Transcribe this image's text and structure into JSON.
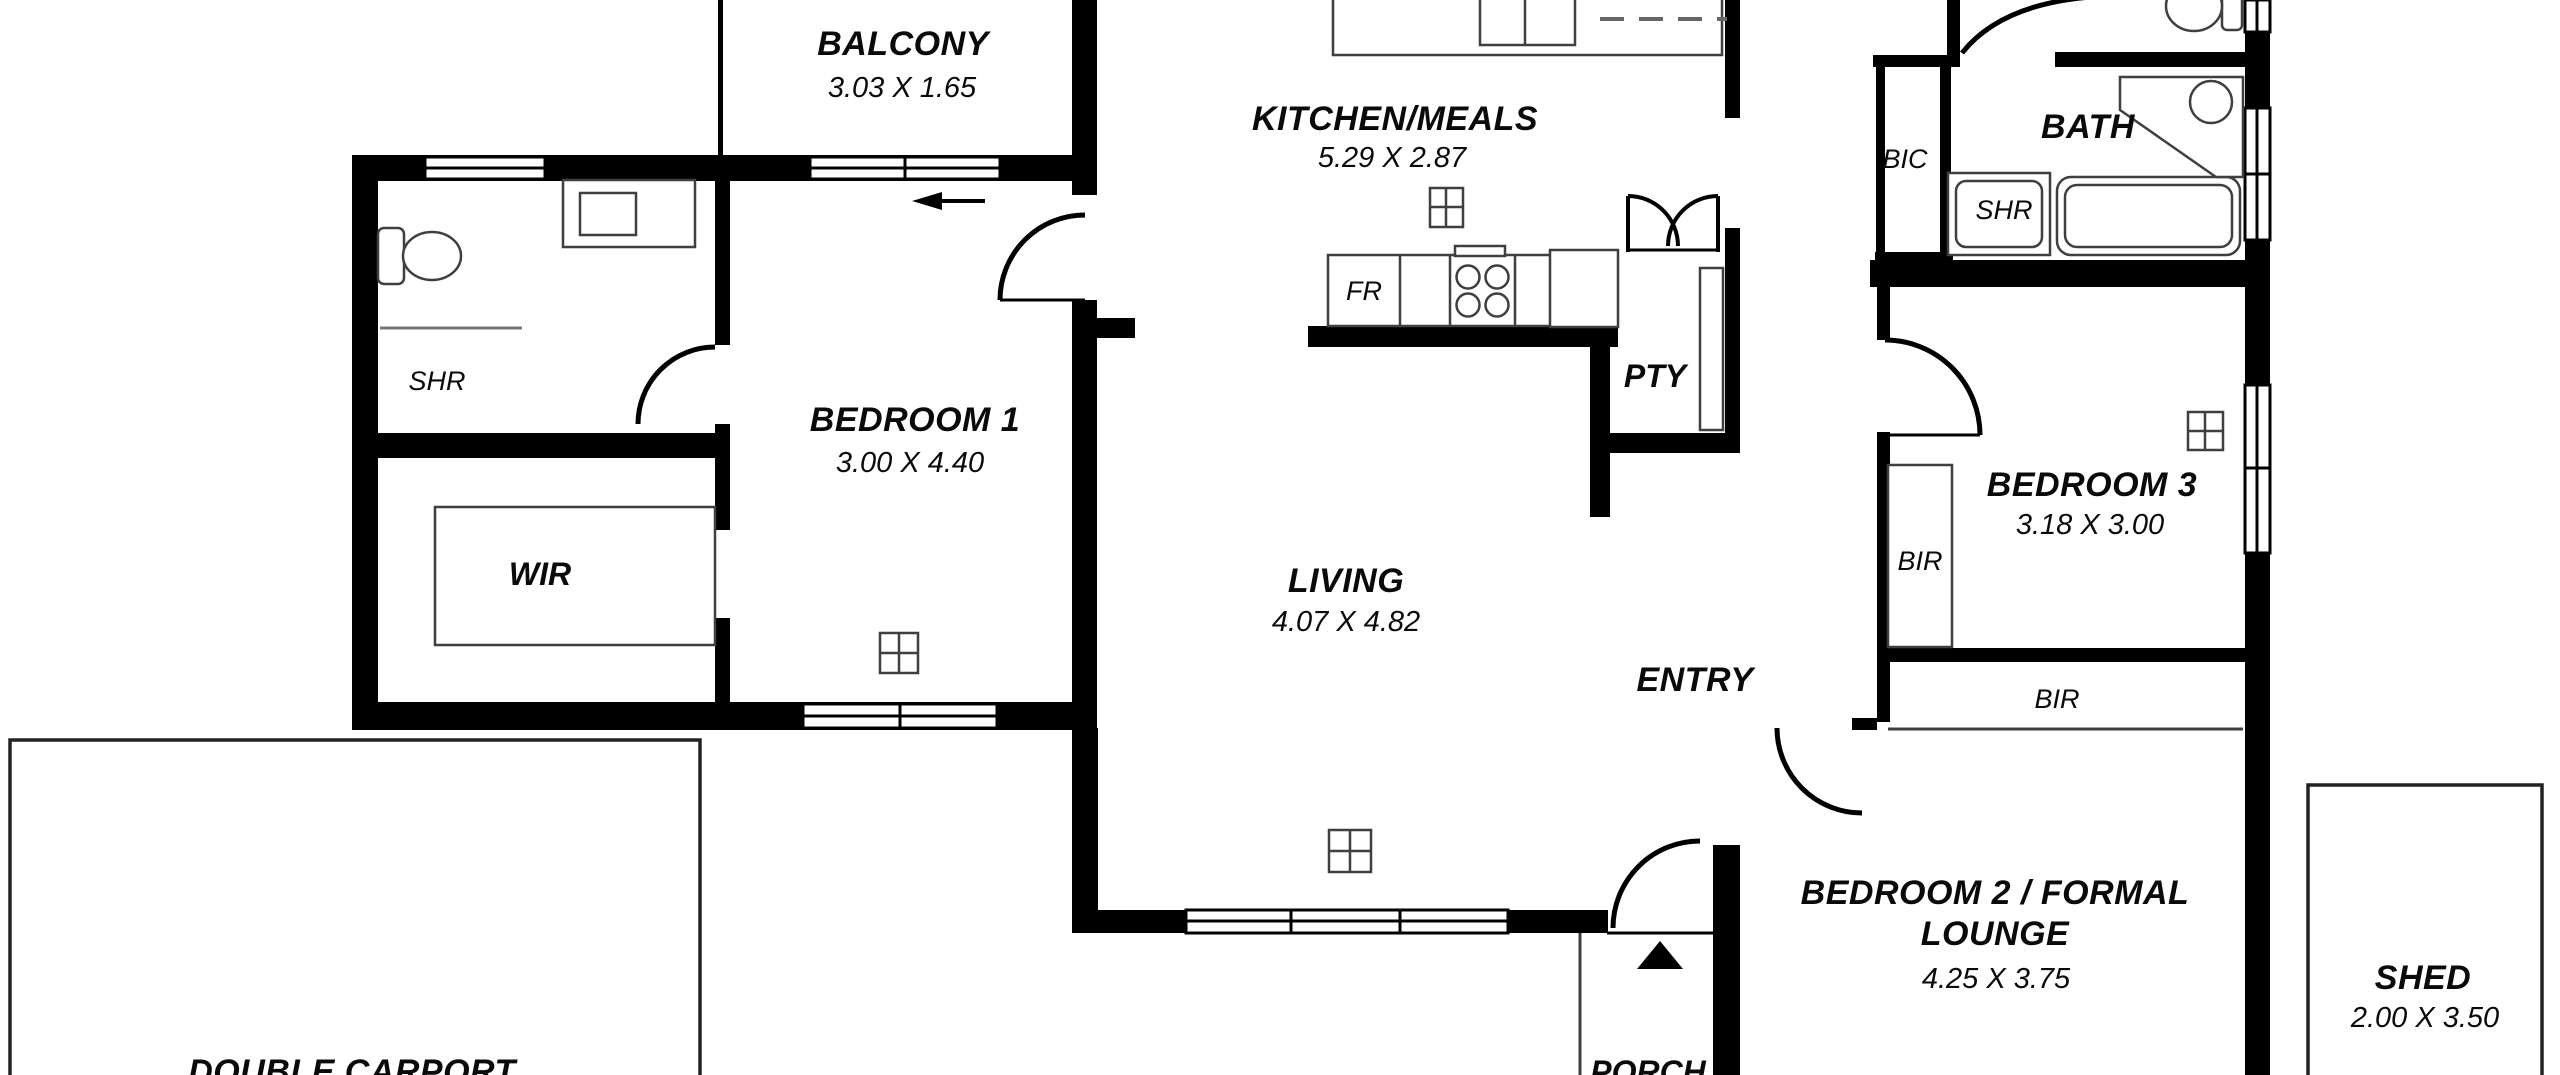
{
  "colors": {
    "wall": "#000000",
    "fixture_line": "#3f3f3f",
    "background": "#ffffff"
  },
  "rooms": {
    "balcony": {
      "label": "BALCONY",
      "dims": "3.03 X 1.65"
    },
    "kitchen_meals": {
      "label": "KITCHEN/MEALS",
      "dims": "5.29 X 2.87"
    },
    "bath": {
      "label": "BATH"
    },
    "bic": {
      "label": "BIC"
    },
    "bath_shower": {
      "label": "SHR"
    },
    "ensuite_shower": {
      "label": "SHR"
    },
    "bedroom1": {
      "label": "BEDROOM 1",
      "dims": "3.00 X 4.40"
    },
    "wir": {
      "label": "WIR"
    },
    "living": {
      "label": "LIVING",
      "dims": "4.07 X 4.82"
    },
    "pantry": {
      "label": "PTY"
    },
    "entry": {
      "label": "ENTRY"
    },
    "bedroom3": {
      "label": "BEDROOM 3",
      "dims": "3.18 X 3.00"
    },
    "bedroom3_robe": {
      "label": "BIR"
    },
    "bedroom2_robe": {
      "label": "BIR"
    },
    "bedroom2": {
      "label_line1": "BEDROOM 2 / FORMAL",
      "label_line2": "LOUNGE",
      "dims": "4.25 X 3.75"
    },
    "shed": {
      "label": "SHED",
      "dims": "2.00 X 3.50"
    },
    "porch": {
      "label": "PORCH"
    },
    "carport": {
      "label": "DOUBLE CARPORT"
    },
    "fridge": {
      "label": "FR"
    }
  }
}
